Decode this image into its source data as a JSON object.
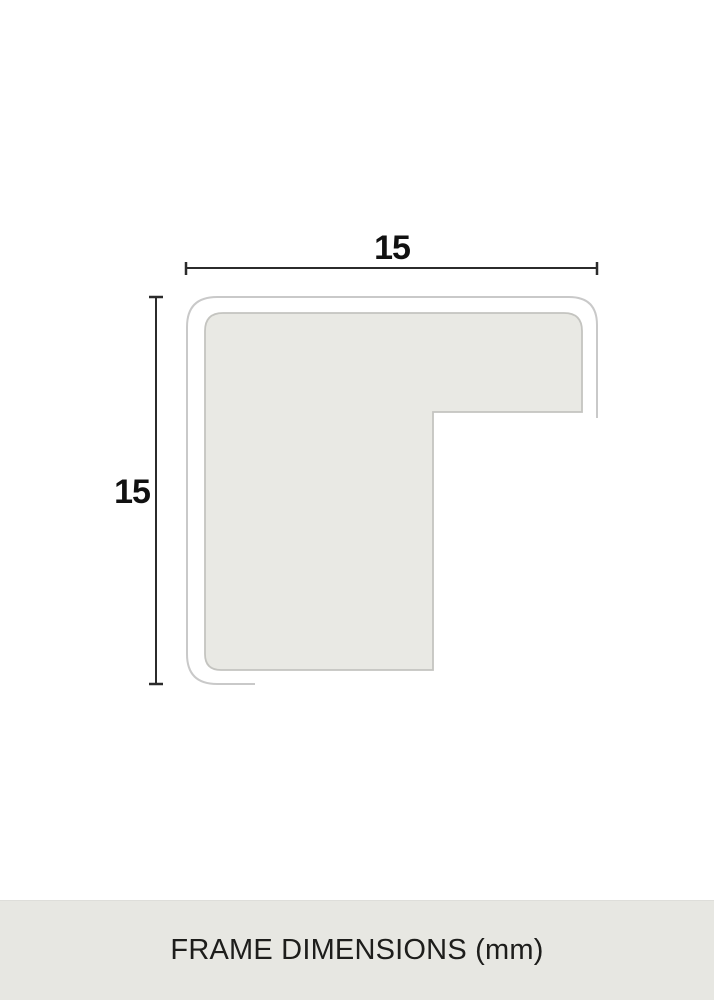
{
  "diagram": {
    "title": "frame profile cross-section",
    "dimensions": {
      "width_label": "15",
      "height_label": "15"
    },
    "colors": {
      "profile_fill": "#e9e9e4",
      "profile_stroke": "#c4c4c0",
      "outline_stroke": "#c9c9c9",
      "dimension_line": "#2b2b2b",
      "label_text": "#111111"
    }
  },
  "footer": {
    "label": "FRAME DIMENSIONS (mm)",
    "background": "#e7e7e2",
    "text_color": "#1d1d1b"
  }
}
